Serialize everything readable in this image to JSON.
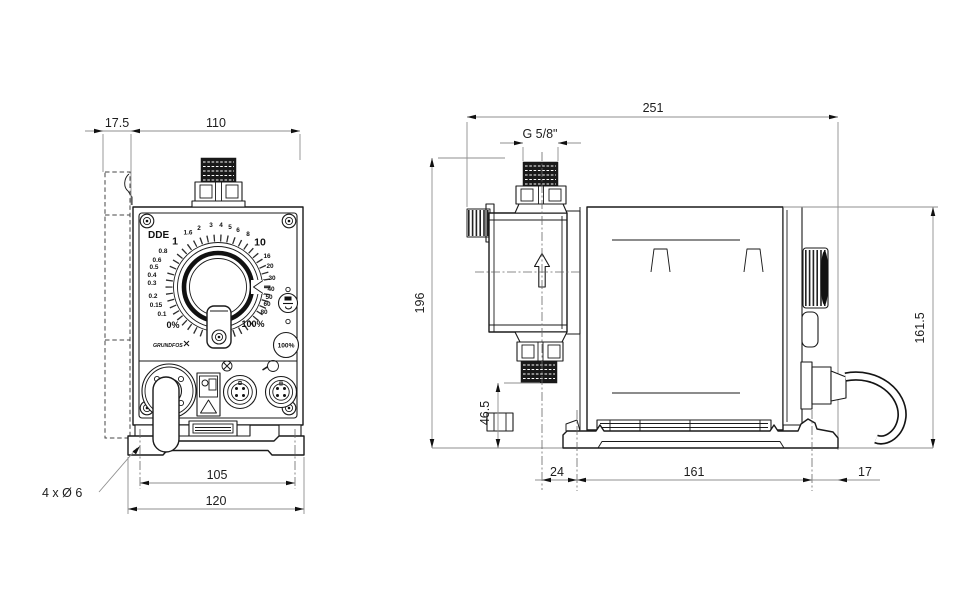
{
  "front_view": {
    "label": "DDE",
    "logo_text": "GRUNDFOS",
    "dial_scale": [
      "1",
      "1.6",
      "2",
      "3",
      "4",
      "5",
      "6",
      "8",
      "10",
      "16",
      "20",
      "30",
      "40",
      "50",
      "60",
      "80"
    ],
    "dial_low_scale": [
      "0.8",
      "0.6",
      "0.5",
      "0.4",
      "0.3",
      "0.2",
      "0.15",
      "0.1"
    ],
    "dial_min": "0%",
    "dial_max": "100%",
    "prime_label": "100%",
    "dim_wall_offset": "17.5",
    "dim_width": "110",
    "dim_hole_spacing": "105",
    "dim_base_width": "120",
    "mounting_holes": "4 x Ø 6"
  },
  "side_view": {
    "dim_depth": "251",
    "dim_thread": "G 5/8\"",
    "dim_height": "196",
    "dim_body_height": "161.5",
    "dim_outlet_height": "46.5",
    "dim_hole_front": "24",
    "dim_hole_spacing": "161",
    "dim_hole_rear": "17"
  }
}
